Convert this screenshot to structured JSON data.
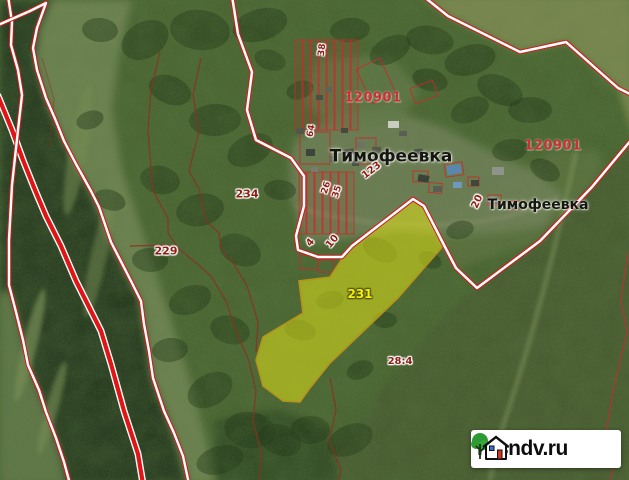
{
  "map": {
    "quarter_codes": [
      "120901",
      "120901"
    ],
    "village_labels": [
      "Тимофеевка",
      "Тимофеевка"
    ],
    "parcel_numbers": {
      "p38": "38",
      "p64": "64",
      "p123": "123",
      "p26": "26",
      "p35": "35",
      "p20": "20",
      "p234": "234",
      "p229": "229",
      "p4": "4",
      "p10": "10",
      "p231": "231",
      "p28_4": "28:4"
    },
    "highlighted_parcel": {
      "number": "231",
      "fill_color": "#dede18"
    },
    "colors": {
      "boundary_red": "#cc2020",
      "thin_boundary_brown": "#8a3322",
      "parcel_label_red": "#8f1d12",
      "quarter_code_red": "#c92a2a",
      "village_label_dark": "#161610",
      "highlight_label_yellow": "#f2ee16"
    }
  },
  "watermark": {
    "text": "rosndv.ru"
  }
}
